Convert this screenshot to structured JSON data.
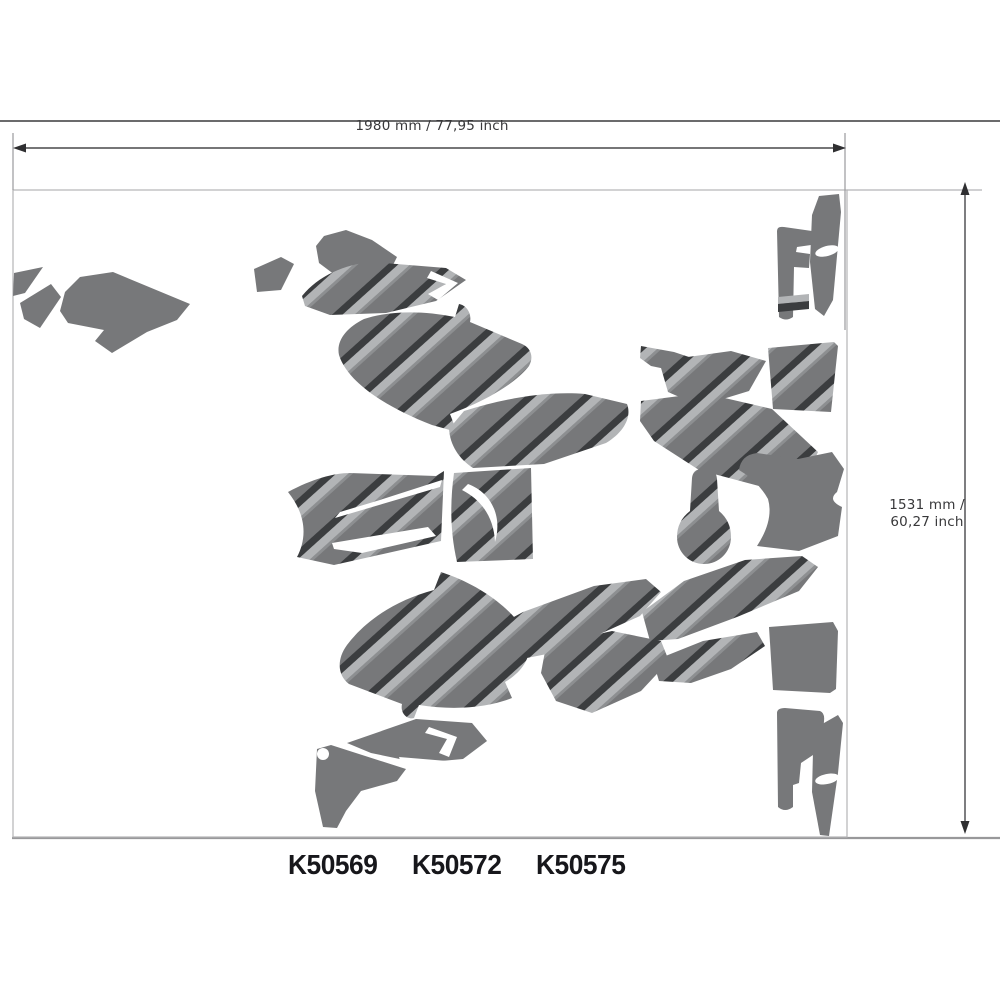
{
  "diagram": {
    "title": "decal kit layout sheet",
    "width_label": "1980 mm / 77,95 inch",
    "height_label_line1": "1531 mm /",
    "height_label_line2": "60,27 inch",
    "part_numbers": [
      "K50569",
      "K50572",
      "K50575"
    ],
    "colors": {
      "decal_gray": "#77787a",
      "stripe_light": "#b2b4b6",
      "stripe_dark": "#3b3d3f",
      "stripe_mid": "#8d8f91",
      "dimension_line": "#48484a",
      "arrowhead": "#2f2f31",
      "sheet_border": "#b4b4b6",
      "frame_line_top": "#3a3a3c",
      "frame_line_bottom": "#98989a",
      "label_text": "#38383a",
      "part_number_text": "#17171b"
    }
  }
}
